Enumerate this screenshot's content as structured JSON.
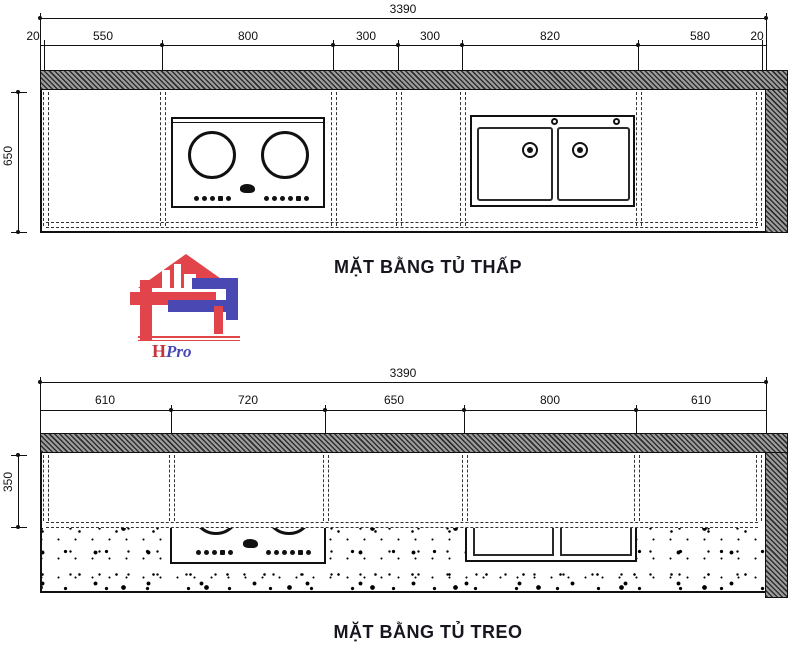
{
  "page": {
    "background": "#ffffff",
    "line_color": "#111111"
  },
  "drawing_low": {
    "title": "MẶT BẰNG TỦ THẤP",
    "total_dim": "3390",
    "segment_dims": [
      "20",
      "550",
      "800",
      "300",
      "300",
      "820",
      "580",
      "20"
    ],
    "height_dim": "650",
    "features": [
      "countertop-hatch-band",
      "two-burner-cooktop",
      "double-bowl-sink",
      "cabinet-dividers"
    ]
  },
  "drawing_hanging": {
    "title": "MẶT BẰNG TỦ TREO",
    "total_dim": "3390",
    "segment_dims": [
      "610",
      "720",
      "650",
      "800",
      "610"
    ],
    "height_dim": "350",
    "features": [
      "countertop-hatch-band",
      "speckled-counter-area",
      "cooktop-front-edge",
      "sink-front-edge"
    ]
  },
  "logo": {
    "text_h": "H",
    "text_pro": "Pro",
    "red": "#e2444b",
    "blue": "#4a49b4"
  }
}
